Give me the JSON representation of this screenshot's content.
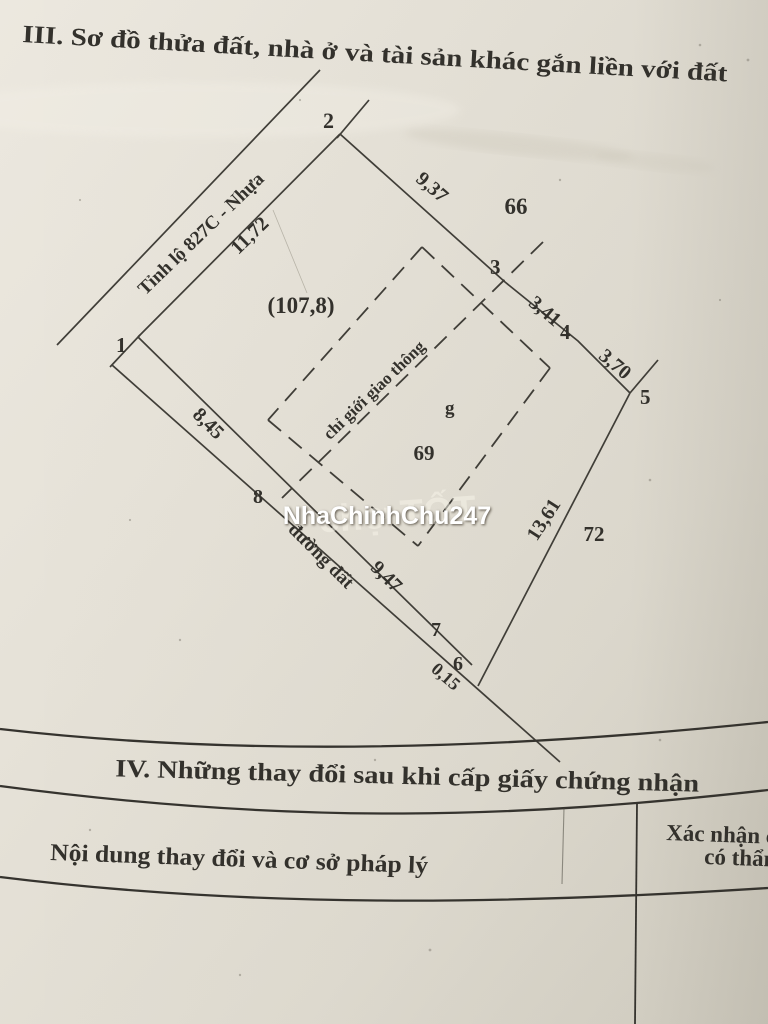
{
  "page": {
    "section3_title": "III. Sơ đồ thửa đất, nhà ở và tài sản khác gắn liền với đất",
    "watermark": "NhaChinhChu247",
    "watermark_ghost": "chợ TỐT"
  },
  "diagram": {
    "road_highway": "Tỉnh lộ 827C - Nhựa",
    "road_dirt": "đường đất",
    "corridor_label": "chỉ giới giao thông",
    "area_label": "(107,8)",
    "parcel_number": "69",
    "structure_letter": "g",
    "neighbor_north": "66",
    "neighbor_southeast": "72",
    "points": {
      "p1": "1",
      "p2": "2",
      "p3": "3",
      "p4": "4",
      "p5": "5",
      "p6": "6",
      "p7": "7",
      "p8": "8"
    },
    "dimensions": {
      "d12": "11,72",
      "d23": "9,37",
      "d34": "3,41",
      "d45": "3,70",
      "d56": "13,61",
      "d67": "0,15",
      "d78": "9,47",
      "d81": "8,45"
    }
  },
  "section4": {
    "title": "IV. Những thay đổi sau khi cấp giấy chứng nhận",
    "col_content_header": "Nội dung thay đổi và cơ sở pháp lý",
    "col_confirm_line1": "Xác nhận c",
    "col_confirm_line2": "có thẩm"
  }
}
